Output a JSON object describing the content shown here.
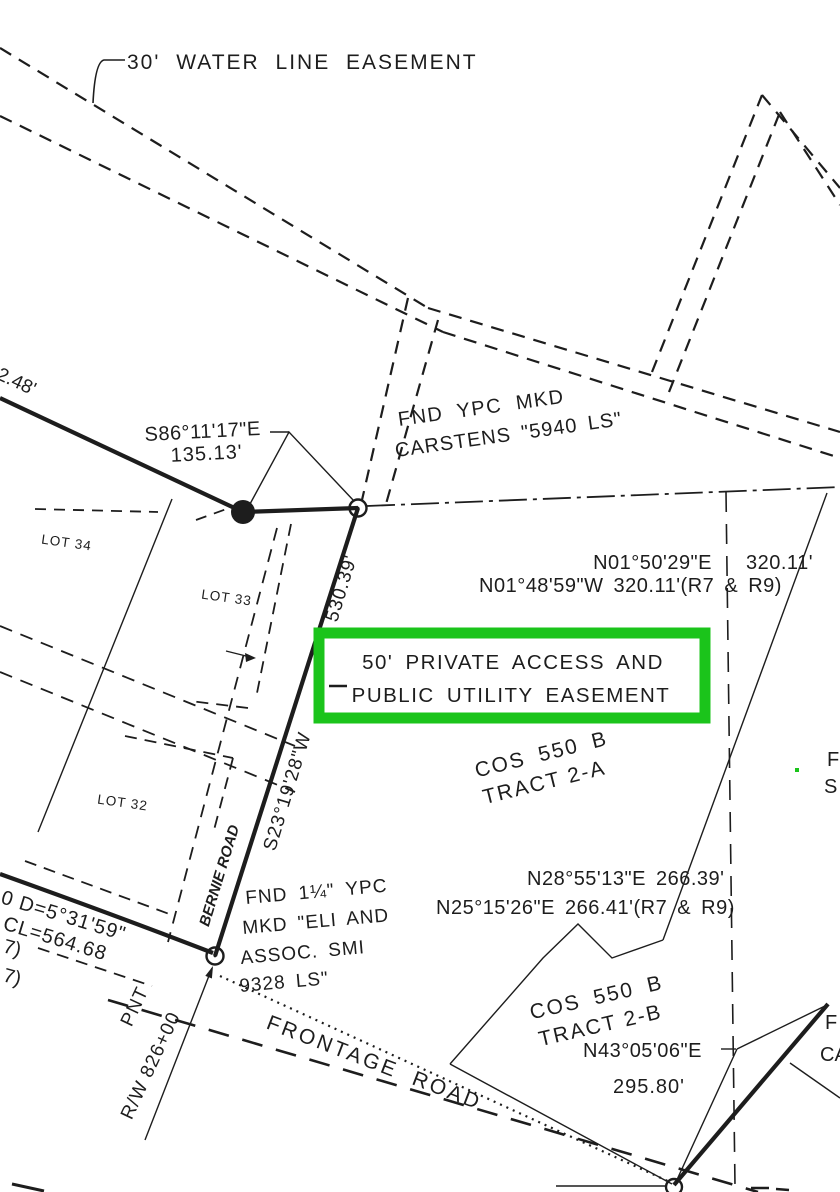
{
  "document": {
    "type": "survey-plat-drawing",
    "highlighted_feature": "50' PRIVATE ACCESS AND PUBLIC UTILITY EASEMENT"
  },
  "colors": {
    "background": "#ffffff",
    "ink": "#1d1d1d",
    "highlight": "#1bc41b"
  },
  "highlight": {
    "line1": "50' PRIVATE ACCESS AND",
    "line2": "PUBLIC UTILITY EASEMENT"
  },
  "labels": {
    "water_easement": "30' WATER LINE EASEMENT",
    "dist_62_48": "62.48'",
    "brg_s86": "S86°11'17\"E",
    "dist_135_13": "135.13'",
    "fnd_carstens_line1": "FND YPC MKD",
    "fnd_carstens_line2": "CARSTENS \"5940 LS\"",
    "brg_n01_meas": "N01°50'29\"E",
    "dist_n01_meas": "320.11'",
    "brg_n01_rec": "N01°48'59\"W  320.11'(R7 & R9)",
    "cos_tract_a_line1": "COS 550 B",
    "cos_tract_a_line2": "TRACT 2-A",
    "lot_34": "LOT 34",
    "lot_33": "LOT 33",
    "lot_32": "LOT 32",
    "road_dist": "530.39'",
    "road_brg": "S23°19'28\"W",
    "road_name": "BERNIE ROAD",
    "curve_delta": "0 D=5°31'59\"",
    "curve_cl": "CL=564.68",
    "ref_7a": "7)",
    "ref_7b": "7)",
    "pnt": "PNT",
    "rw_station": "R/W 826+00",
    "fnd_eli_line1": "FND 1¼\" YPC",
    "fnd_eli_line2": "MKD \"ELI AND",
    "fnd_eli_line3": "ASSOC. SMI",
    "fnd_eli_line4": "9328 LS\"",
    "brg_n28_meas": "N28°55'13\"E  266.39'",
    "brg_n25_rec": "N25°15'26\"E  266.41'(R7 & R9)",
    "cos_tract_b_line1": "COS 550 B",
    "cos_tract_b_line2": "TRACT 2-B",
    "brg_n43": "N43°05'06\"E",
    "dist_n43": "295.80'",
    "frontage_road": "FRONTAGE ROAD",
    "edge_partial_f1": "F",
    "edge_partial_s": "S",
    "edge_partial_f2": "F",
    "edge_partial_ca": "CA"
  }
}
